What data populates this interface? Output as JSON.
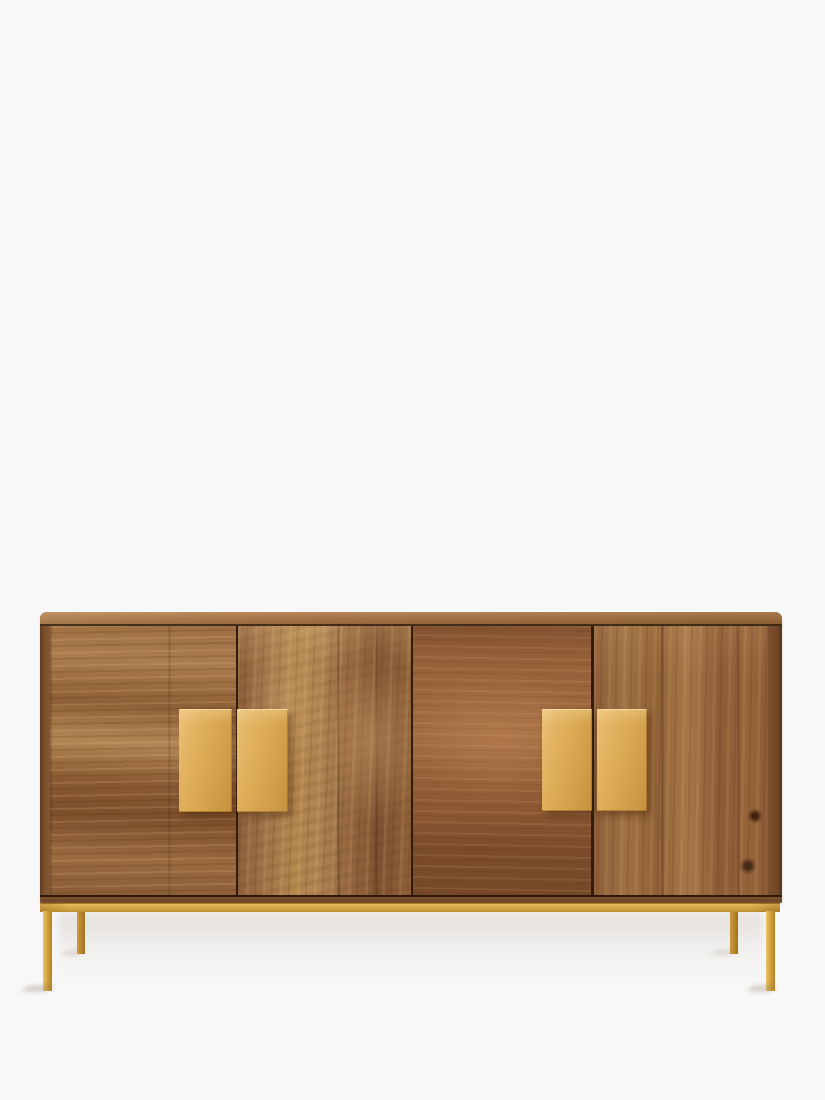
{
  "scene": {
    "description": "Studio product photograph of a wide mango-wood sideboard with four doors, two pairs of square brass handles and a slim brass metal base frame with four legs, shot straight-on against a plain off-white background",
    "background_color": "#f8f8f8",
    "floor_shadow_color": "rgba(120,95,70,0.16)"
  },
  "sideboard": {
    "door_count": 4,
    "handle_pair_count": 2,
    "handle_plate_count": 4,
    "leg_count": 4,
    "parts": {
      "top": "rounded-edge wooden top slab",
      "doors": "four flat wooden doors with thin dark gaps",
      "handles": "flat square brass plates flanking door gaps",
      "plinth": "dark wood bottom strip",
      "base": "thin brass rail with four square-section legs"
    },
    "colors": {
      "wood_light": "#b38652",
      "wood_mid": "#96683e",
      "wood_dark": "#6e4426",
      "wood_top": "#aa7a4b",
      "door_seam": "#20100a",
      "brass_handle": "#dcab55",
      "brass_rail": "#d5a747",
      "brass_leg_front": "#d6a742",
      "brass_leg_back": "#b4842a"
    }
  }
}
